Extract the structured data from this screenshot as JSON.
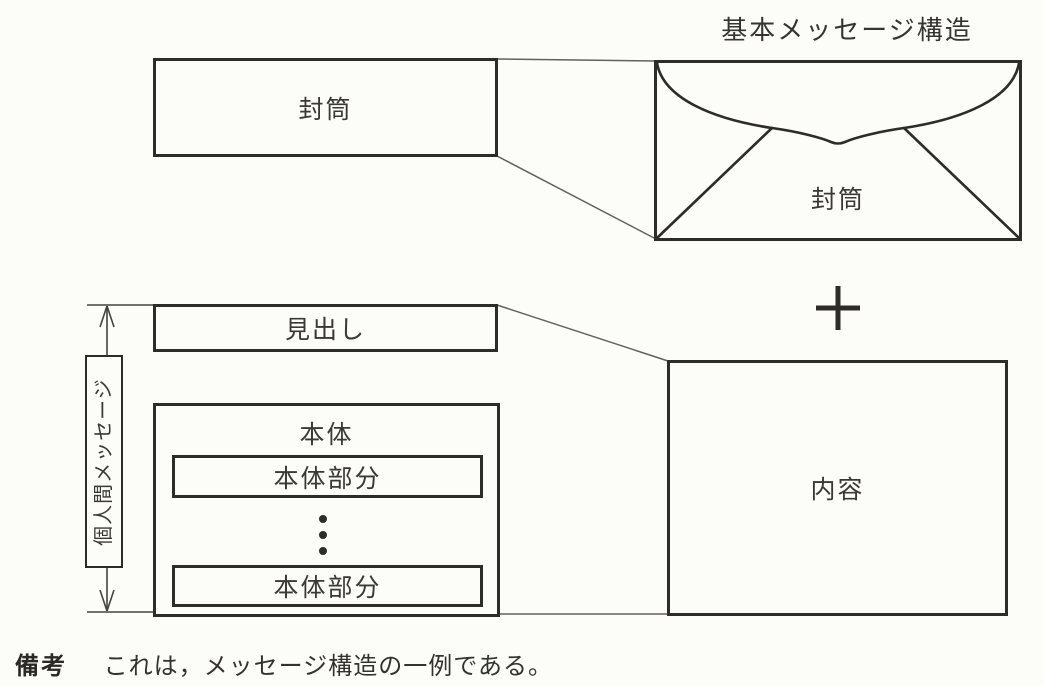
{
  "title": "基本メッセージ構造",
  "boxes": {
    "envelope_schematic": {
      "label": "封筒"
    },
    "envelope_pictorial": {
      "label": "封筒"
    },
    "heading": {
      "label": "見出し"
    },
    "body": {
      "label": "本体"
    },
    "body_parts": [
      {
        "label": "本体部分"
      },
      {
        "label": "本体部分"
      }
    ],
    "content": {
      "label": "内容"
    }
  },
  "bracket": {
    "label": "個人間メッセージ"
  },
  "icons": {
    "plus_icon": "+",
    "vertical_ellipsis_icon": "⋮"
  },
  "note": {
    "heading": "備考",
    "text": "これは，メッセージ構造の一例である。"
  },
  "colors": {
    "background": "#fcfcf9",
    "line": "#2d2c27",
    "thin_line": "#63625a"
  }
}
